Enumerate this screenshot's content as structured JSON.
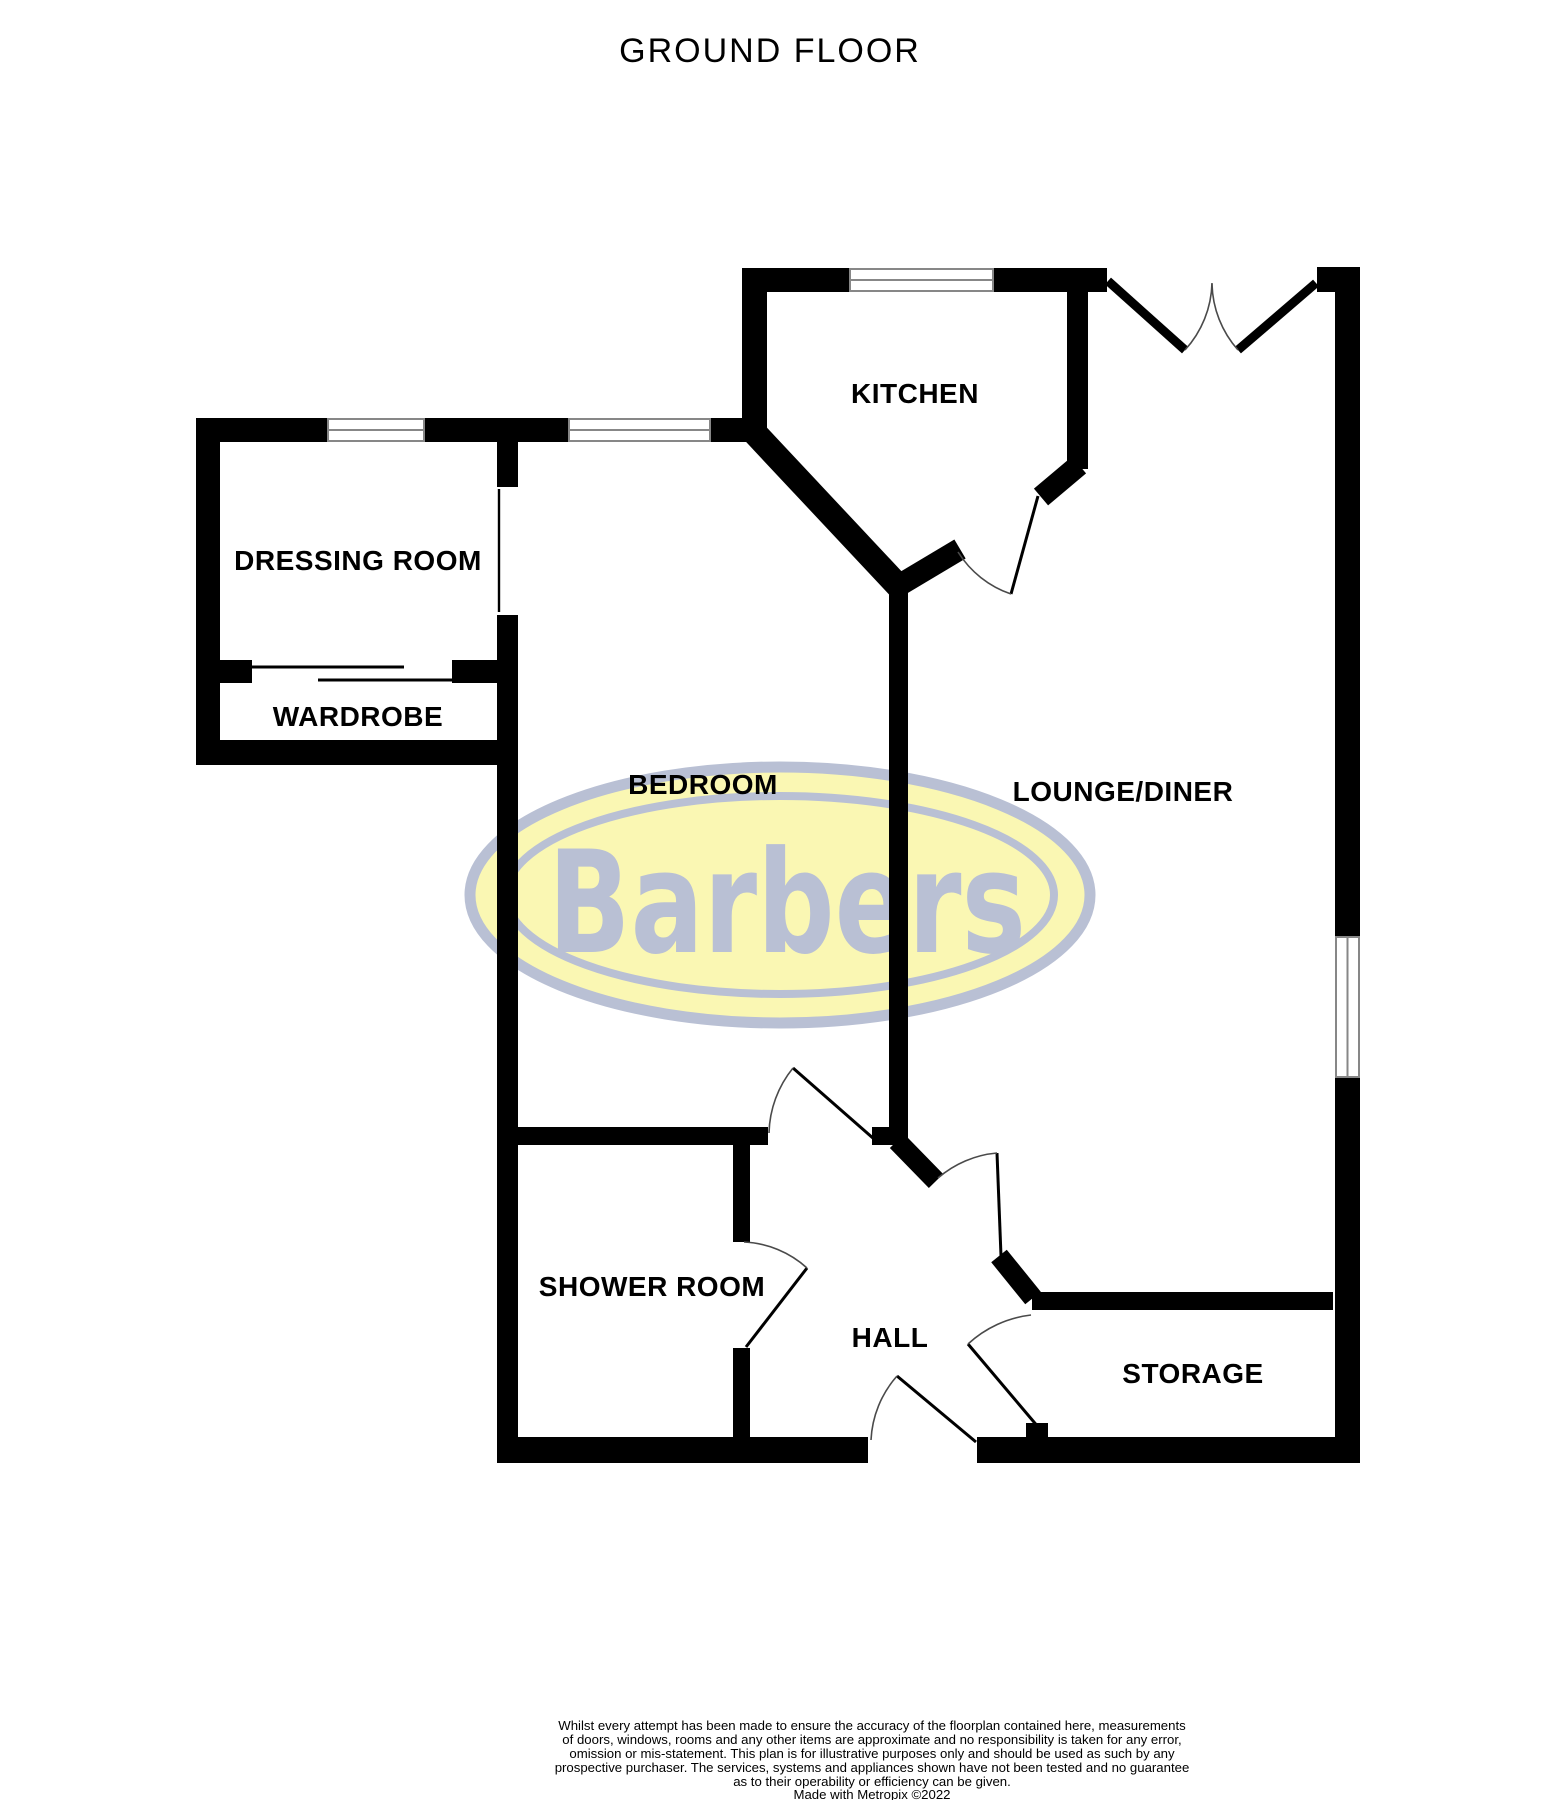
{
  "title": "GROUND FLOOR",
  "rooms": {
    "kitchen": "KITCHEN",
    "dressing": "DRESSING ROOM",
    "wardrobe": "WARDROBE",
    "bedroom": "BEDROOM",
    "lounge": "LOUNGE/DINER",
    "shower": "SHOWER ROOM",
    "hall": "HALL",
    "storage": "STORAGE"
  },
  "logo": {
    "text": "Barbers",
    "fill_color": "#faf7b3",
    "ring_color": "#b9c0d4"
  },
  "colors": {
    "wall": "#000000",
    "window_frame": "#878787",
    "door_arc": "#4a4a4a",
    "label_text": "#000000"
  },
  "footer": {
    "lines": [
      "Whilst every attempt has been made to ensure the accuracy of the floorplan contained here, measurements",
      "of doors, windows, rooms and any other items are approximate and no responsibility is taken for any error,",
      "omission or mis-statement. This plan is for illustrative purposes only and should be used as such by any",
      "prospective purchaser. The services, systems and appliances shown have not been tested and no guarantee",
      "as to their operability or efficiency can be given.",
      "Made with Metropix ©2022"
    ]
  }
}
